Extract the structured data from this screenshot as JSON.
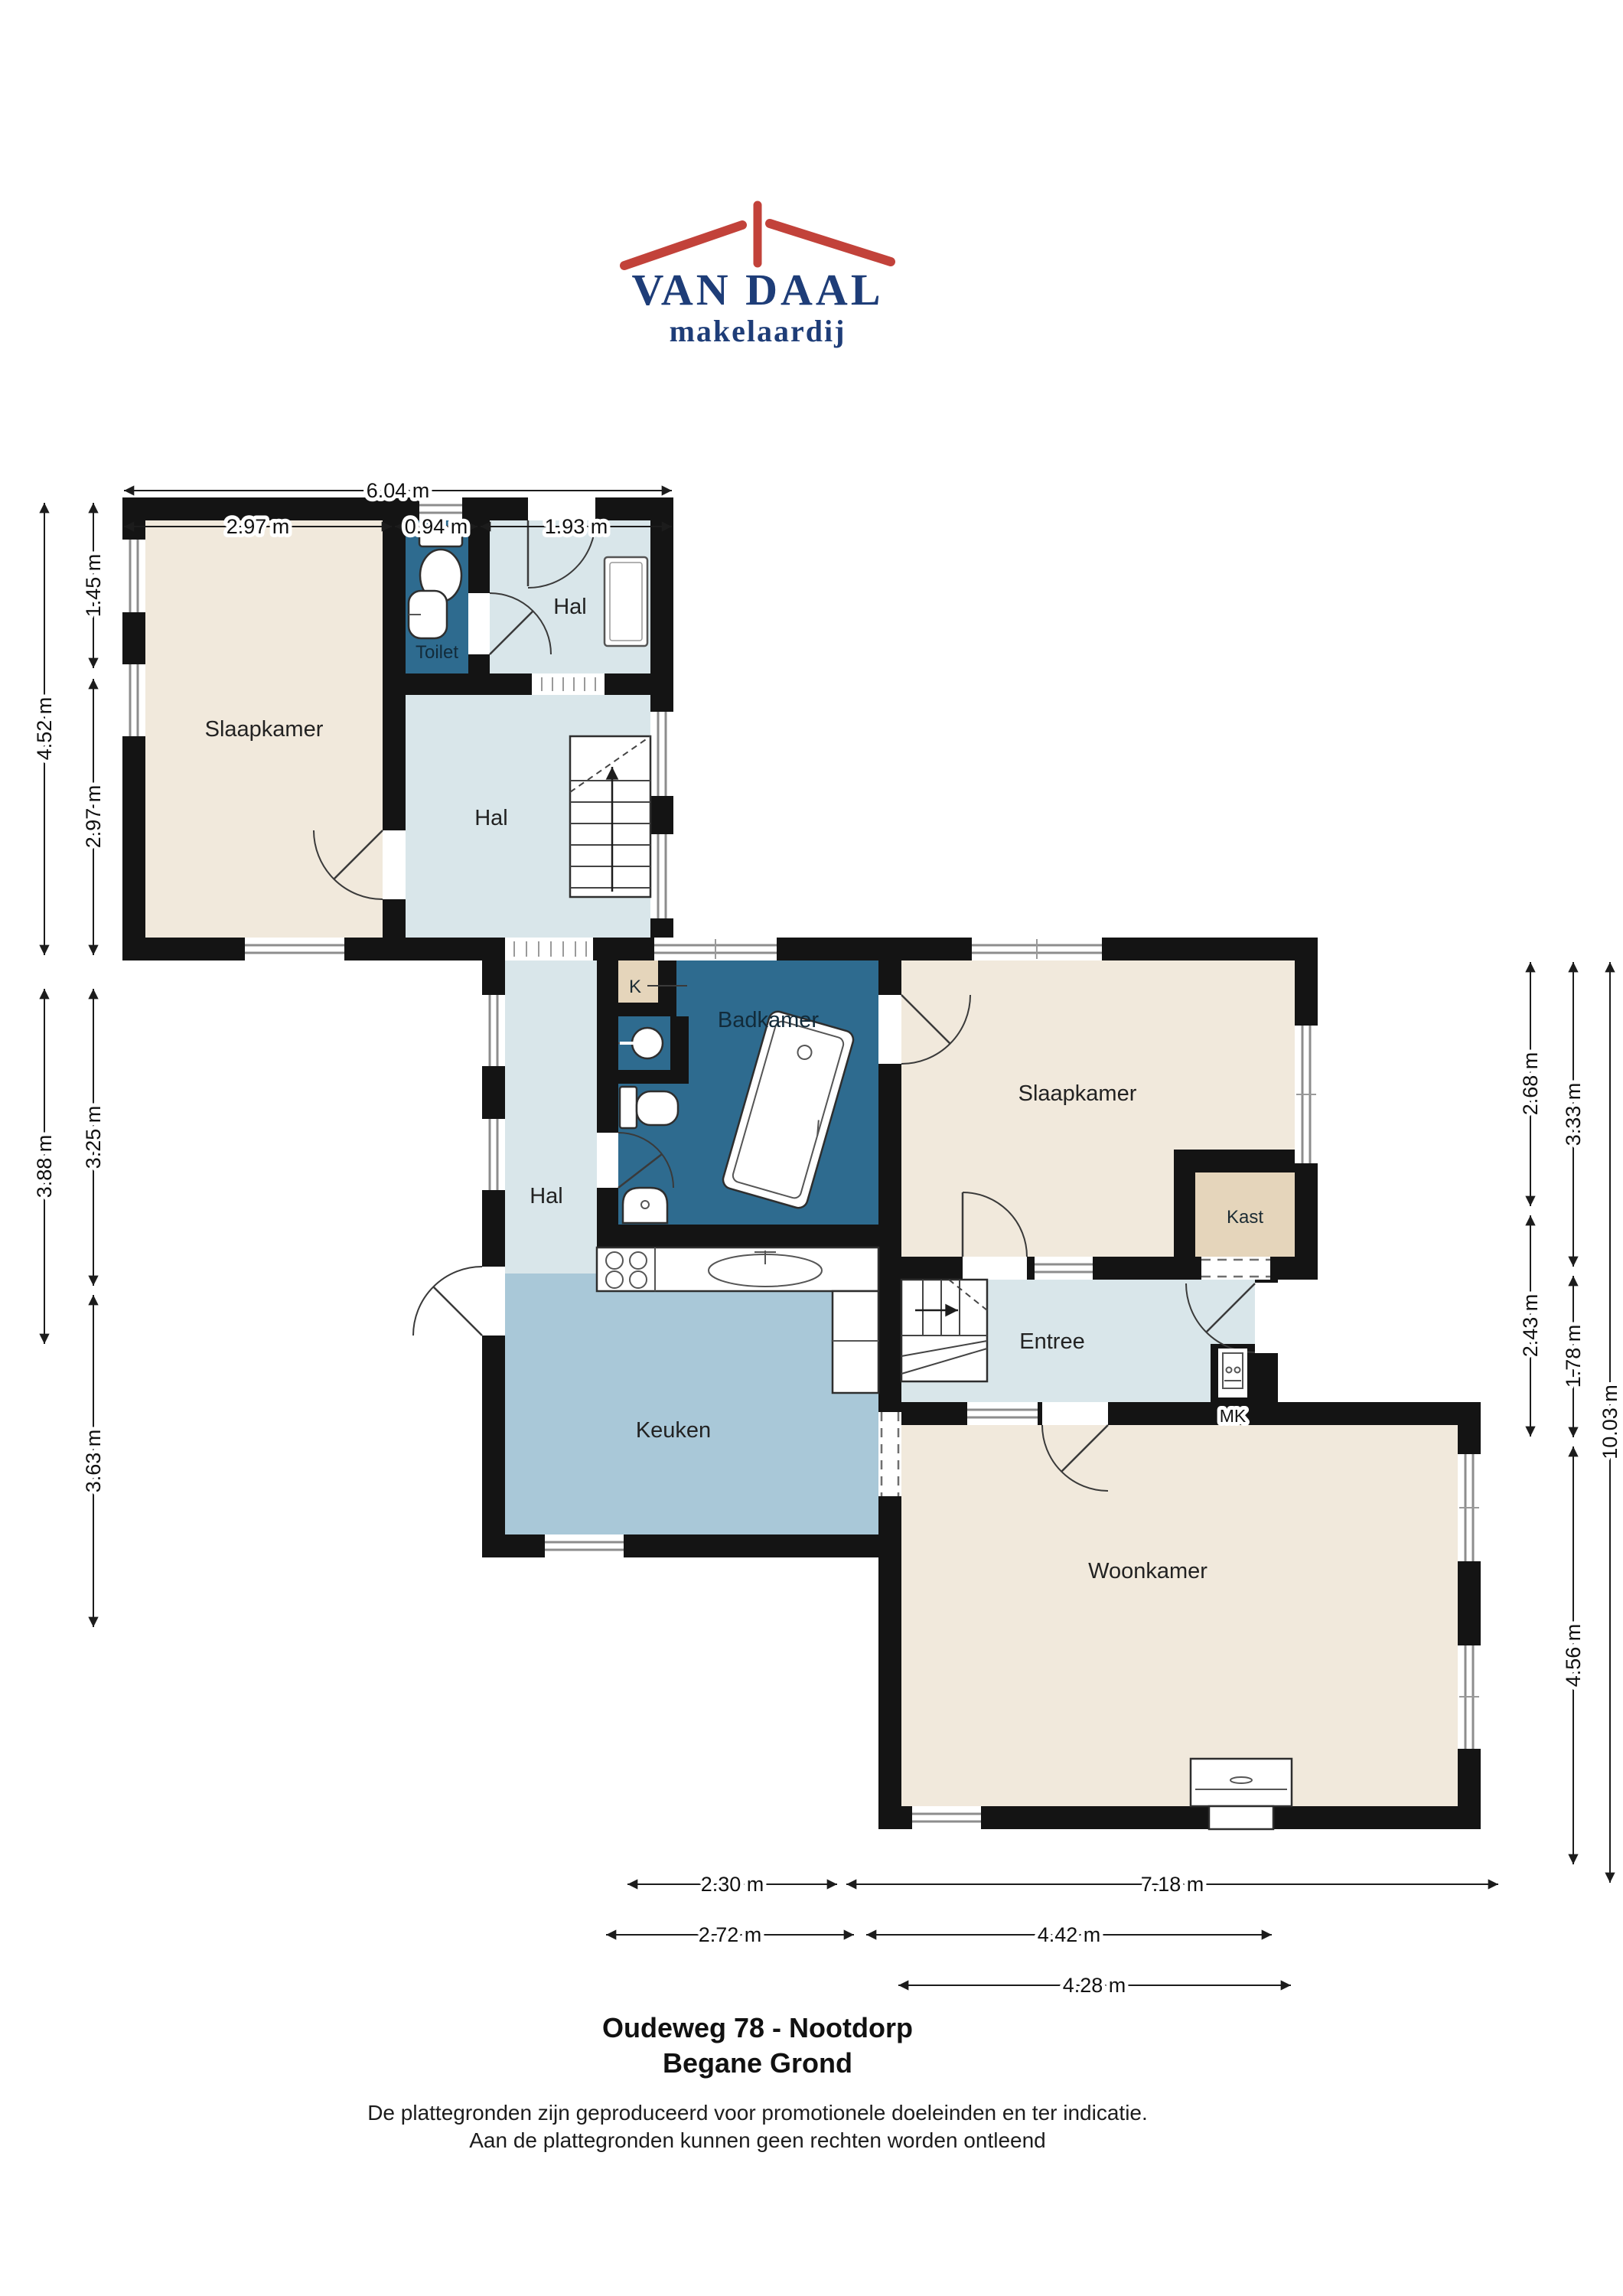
{
  "logo": {
    "name": "VAN DAAL",
    "tagline": "makelaardij"
  },
  "plan": {
    "rooms": {
      "slaapkamer_left": "Slaapkamer",
      "toilet": "Toilet",
      "hal_top": "Hal",
      "hal_mid": "Hal",
      "hal_corridor": "Hal",
      "badkamer": "Badkamer",
      "closet_k": "K",
      "slaapkamer_right": "Slaapkamer",
      "kast": "Kast",
      "entree": "Entree",
      "meterkast": "MK",
      "keuken": "Keuken",
      "woonkamer": "Woonkamer"
    },
    "dimensions": {
      "top_total": "6.04 m",
      "top_seg1": "2.97 m",
      "top_seg2": "0.94 m",
      "top_seg3": "1.93 m",
      "left_outer_seg1": "4.52 m",
      "left_outer_seg2": "3.88 m",
      "left_inner_seg1": "1.45 m",
      "left_inner_seg2": "2.97 m",
      "left_inner_seg3": "3.25 m",
      "left_inner_seg4": "3.63 m",
      "right_inner_seg1": "2.68 m",
      "right_inner_seg2": "2.43 m",
      "right_mid_seg1": "3.33 m",
      "right_mid_seg2": "1.78 m",
      "right_mid_seg3": "4.56 m",
      "right_outer_total": "10.03 m",
      "bottom_row1_seg1": "2.30 m",
      "bottom_row1_seg2": "7.18 m",
      "bottom_row2_seg1": "2.72 m",
      "bottom_row2_seg2": "4.42 m",
      "bottom_row3_seg1": "4.28 m"
    }
  },
  "footer": {
    "title": "Oudeweg 78 - Nootdorp",
    "subtitle": "Begane Grond",
    "disclaimer_line1": "De plattegronden zijn geproduceerd voor promotionele doeleinden en ter indicatie.",
    "disclaimer_line2": "Aan de plattegronden kunnen geen rechten worden ontleend"
  },
  "colors": {
    "wall": "#141414",
    "room_beige": "#f1e9dc",
    "hal_light_blue": "#d9e6ea",
    "keuken_blue": "#a9c8d8",
    "wet_room_blue": "#2e6b8f",
    "closet_beige": "#e5d5bb",
    "logo_navy": "#1e3d78",
    "logo_red": "#c2423a"
  }
}
